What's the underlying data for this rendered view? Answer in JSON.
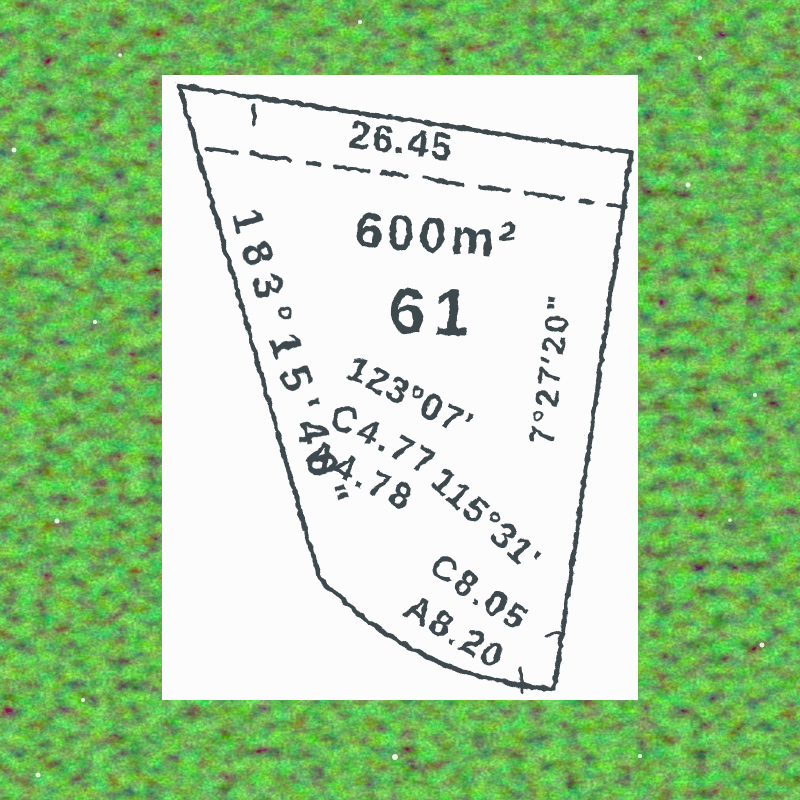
{
  "image_type": "lot-survey-plat-on-grass-photo",
  "lot": {
    "area_label": "600m²",
    "lot_number": "61"
  },
  "boundaries": {
    "top_length": "26.45",
    "left_bearing": "183°15'40\"",
    "right_bearing": "7°27'20\"",
    "bottom_bearing_1": "123°07'",
    "bottom_chord_1": "C4.77",
    "bottom_arc_1": "A4.78",
    "bottom_bearing_2": "115°31'",
    "bottom_chord_2": "C8.05",
    "bottom_arc_2": "A8.20"
  },
  "colors": {
    "ink": "#3e484e",
    "panel_background": "#fcfcfc",
    "grass_base": "#1c7d12",
    "grass_highlight": "#6fd14a",
    "grass_shadow": "#063a06"
  }
}
